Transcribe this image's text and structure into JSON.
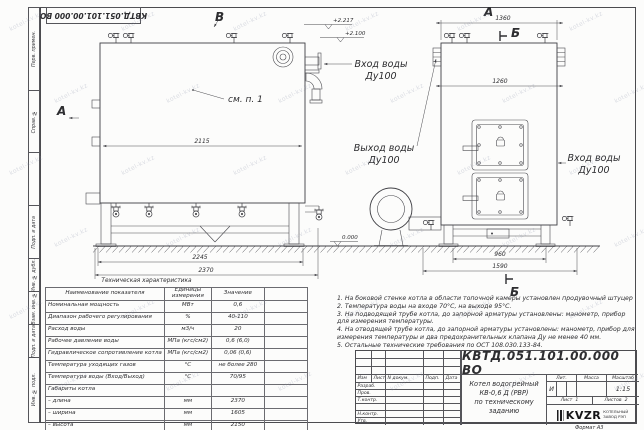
{
  "frame": {
    "designation_flipped": "КВТД.051.101.00.000 ВО",
    "left_column": [
      "Перв. примен.",
      "Справ. №",
      "Подп. и дата",
      "Инв. № дубл.",
      "Взам. инв. №",
      "Подп. и дата",
      "Инв. № подл."
    ],
    "format_note": "Формат А3"
  },
  "watermark": {
    "text": "kotel-kv.kz"
  },
  "drawing": {
    "marker_a": "А",
    "marker_b": "В",
    "marker_sec": "Б",
    "see_note": "см. п. 1",
    "inlet_label": "Вход воды",
    "outlet_label": "Выход воды",
    "dn_label": "Ду100",
    "elev_top": "+2.217",
    "elev_mid": "+2.100",
    "elev_zero": "0.000",
    "dims": {
      "left_width": "2115",
      "base_width": "2245",
      "total_length": "2370",
      "front_top": "1360",
      "front_width": "1260",
      "support_width": "960",
      "front_total": "1590"
    }
  },
  "tech_table": {
    "title": "Техническая характеристика",
    "headers": [
      "Наименование показателя",
      "Единицы измерения",
      "Значение"
    ],
    "rows": [
      [
        "Номинальная мощность",
        "МВт",
        "0,6"
      ],
      [
        "Диапазон рабочего регулирования",
        "%",
        "40-110"
      ],
      [
        "Расход воды",
        "м3/ч",
        "20"
      ],
      [
        "Рабочее давление воды",
        "МПа (кгс/см2)",
        "0,6 (6,0)"
      ],
      [
        "Гидравлическое сопротивление котла",
        "МПа (кгс/см2)",
        "0,06 (0,6)"
      ],
      [
        "Температура уходящих газов",
        "°С",
        "не более 280"
      ],
      [
        "Температура воды (Вход/Выход)",
        "°С",
        "70/95"
      ],
      [
        "Габариты котла",
        "",
        ""
      ],
      [
        "– длина",
        "мм",
        "2370"
      ],
      [
        "– ширина",
        "мм",
        "1605"
      ],
      [
        "– высота",
        "мм",
        "2150"
      ]
    ]
  },
  "notes": [
    "1. На боковой стенке котла в области топочной камеры установлен продувочный штуцер",
    "2. Температура воды на входе 70°С, на выходе 95°С.",
    "3. На подводящей трубе котла, до запорной арматуры установлены: манометр, прибор для измерения температуры.",
    "4. На отводящей трубе котла, до запорной арматуры установлены: манометр, прибор для измерения температуры и два предохранительных клапана Ду не менее 40 мм.",
    "5. Остальные технические требования по ОСТ 108.030.133-84."
  ],
  "title_block": {
    "designation": "КВТД.051.101.00.000 ВО",
    "doc_name_line1": "Котел водогрейный",
    "doc_name_line2": "КВ-0,6 Д (РВР)",
    "doc_name_line3": "по техническому заданию",
    "header_cols": [
      "Изм",
      "Лист",
      "N докум.",
      "Подп.",
      "Дата"
    ],
    "sig_rows": [
      "Разраб.",
      "Пров.",
      "Т.контр.",
      "",
      "Н.контр.",
      "Утв."
    ],
    "lit_label": "Лит.",
    "mass_label": "Масса",
    "scale_label": "Масштаб",
    "lit_value": "И",
    "scale_value": "1:15",
    "sheet_label": "Лист",
    "sheet_value": "1",
    "sheets_label": "Листов",
    "sheets_value": "2",
    "company_logo": "KVZR",
    "company_name_line1": "КОТЕЛЬНЫЙ",
    "company_name_line2": "ЗАВОД РЭП"
  }
}
